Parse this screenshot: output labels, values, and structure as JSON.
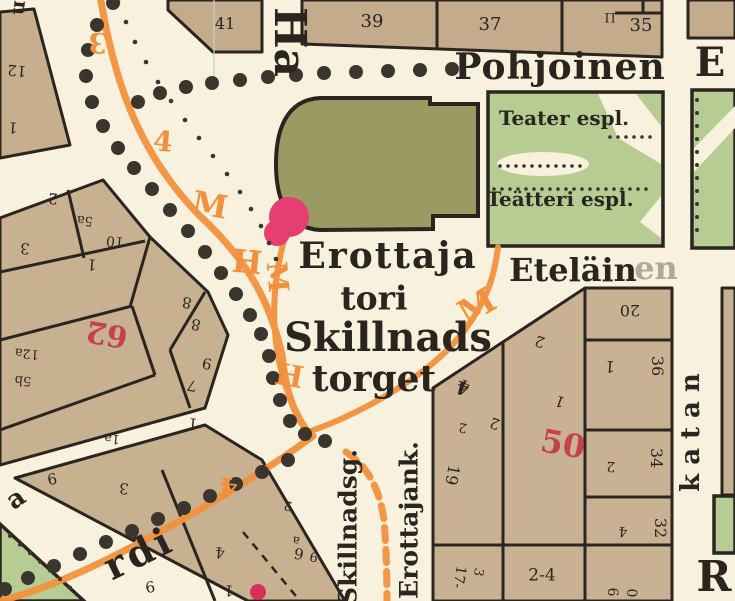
{
  "map": {
    "colors": {
      "background": "#f8f1dd",
      "block_tan": "#c8b191",
      "block_tan_top": "#c3ab8c",
      "park_green": "#b6cc92",
      "theater_olive": "#9a9b62",
      "route_orange": "#f2913d",
      "red_number": "#c4424d",
      "pink_marker": "#e63e72",
      "ink_black": "#2b2520"
    },
    "labels": [
      {
        "n": "street-pohjoinen",
        "t": "Pohjoinen",
        "x": 560,
        "y": 67,
        "s": 36,
        "w": 700,
        "ls": 1
      },
      {
        "n": "street-esplanad-e",
        "t": "E",
        "x": 710,
        "y": 63,
        "s": 40,
        "w": 700
      },
      {
        "n": "street-ha",
        "t": "Ha",
        "x": 289,
        "y": 42,
        "r": 90,
        "s": 44,
        "w": 700
      },
      {
        "n": "park-label-teater",
        "t": "Teater espl.",
        "x": 564,
        "y": 118,
        "s": 20,
        "w": 700
      },
      {
        "n": "park-label-teatteri",
        "t": "Teätteri espl.",
        "x": 560,
        "y": 199,
        "s": 20,
        "w": 700
      },
      {
        "n": "square-erottaja",
        "t": "Erottaja",
        "x": 388,
        "y": 256,
        "s": 36,
        "w": 700,
        "ls": 2
      },
      {
        "n": "square-tori",
        "t": "tori",
        "x": 374,
        "y": 298,
        "s": 33,
        "w": 700
      },
      {
        "n": "square-skillnads",
        "t": "Skillnads",
        "x": 388,
        "y": 338,
        "s": 40,
        "w": 700
      },
      {
        "n": "square-torget",
        "t": "torget",
        "x": 374,
        "y": 379,
        "s": 36,
        "w": 700
      },
      {
        "n": "street-etelainen",
        "t": "Eteläin",
        "x": 573,
        "y": 270,
        "s": 32,
        "w": 700
      },
      {
        "n": "street-etelainen-faded",
        "t": "en",
        "x": 656,
        "y": 268,
        "s": 32,
        "w": 700,
        "o": 0.35
      },
      {
        "n": "street-skillnadsg",
        "t": "Skillnadsg.",
        "x": 348,
        "y": 527,
        "r": -90,
        "s": 25,
        "w": 700
      },
      {
        "n": "street-erottajank",
        "t": "Erottajank.",
        "x": 409,
        "y": 520,
        "r": -90,
        "s": 25,
        "w": 700
      },
      {
        "n": "street-katan",
        "t": "katan",
        "x": 691,
        "y": 428,
        "r": -90,
        "s": 26,
        "w": 700,
        "ls": 9
      },
      {
        "n": "street-r",
        "t": "R",
        "x": 714,
        "y": 577,
        "s": 42,
        "w": 700
      },
      {
        "n": "street-rdi",
        "t": "rdi",
        "x": 139,
        "y": 553,
        "r": -26,
        "s": 38,
        "w": 700,
        "ls": 4
      },
      {
        "n": "street-letter-a",
        "t": "a",
        "x": 16,
        "y": 499,
        "r": -35,
        "s": 26,
        "w": 700
      },
      {
        "n": "street-letter-n",
        "t": "n",
        "x": 21,
        "y": 8,
        "r": 95,
        "s": 20,
        "w": 700
      },
      {
        "n": "plot-number",
        "t": "41",
        "x": 225,
        "y": 24,
        "s": 16
      },
      {
        "n": "plot-number",
        "t": "39",
        "x": 372,
        "y": 22,
        "s": 18
      },
      {
        "n": "plot-number",
        "t": "37",
        "x": 490,
        "y": 25,
        "s": 18
      },
      {
        "n": "plot-number",
        "t": "35",
        "x": 641,
        "y": 26,
        "s": 18
      },
      {
        "n": "landmark-symbol",
        "t": "Π",
        "x": 610,
        "y": 19,
        "s": 13
      },
      {
        "n": "plot-number",
        "t": "12",
        "x": 17,
        "y": 70,
        "r": 185,
        "s": 15
      },
      {
        "n": "plot-number",
        "t": "1",
        "x": 13,
        "y": 127,
        "r": 185,
        "s": 15
      },
      {
        "n": "plot-number",
        "t": "2",
        "x": 53,
        "y": 198,
        "r": 185,
        "s": 15
      },
      {
        "n": "plot-number",
        "t": "5a",
        "x": 85,
        "y": 220,
        "r": 185,
        "s": 13
      },
      {
        "n": "plot-number",
        "t": "3",
        "x": 25,
        "y": 248,
        "r": 185,
        "s": 15
      },
      {
        "n": "plot-number",
        "t": "10",
        "x": 115,
        "y": 241,
        "r": 185,
        "s": 14
      },
      {
        "n": "plot-number",
        "t": "1",
        "x": 92,
        "y": 264,
        "r": 185,
        "s": 15
      },
      {
        "n": "plot-number",
        "t": "8",
        "x": 187,
        "y": 302,
        "r": 190,
        "s": 15
      },
      {
        "n": "plot-number",
        "t": "8",
        "x": 196,
        "y": 324,
        "r": 190,
        "s": 15
      },
      {
        "n": "plot-number",
        "t": "9",
        "x": 207,
        "y": 363,
        "r": 190,
        "s": 15
      },
      {
        "n": "plot-number",
        "t": "7",
        "x": 192,
        "y": 385,
        "r": 190,
        "s": 15
      },
      {
        "n": "plot-number",
        "t": "12a",
        "x": 27,
        "y": 353,
        "r": 185,
        "s": 13
      },
      {
        "n": "plot-number",
        "t": "5b",
        "x": 23,
        "y": 380,
        "r": 185,
        "s": 13
      },
      {
        "n": "block-number-62",
        "t": "62",
        "x": 107,
        "y": 333,
        "r": 190,
        "s": 30,
        "w": 700,
        "c": "#c4424d"
      },
      {
        "n": "plot-number",
        "t": "1a",
        "x": 112,
        "y": 438,
        "r": 185,
        "s": 13
      },
      {
        "n": "plot-number",
        "t": "3",
        "x": 124,
        "y": 488,
        "r": 185,
        "s": 15
      },
      {
        "n": "plot-number",
        "t": "9",
        "x": 52,
        "y": 478,
        "r": 170,
        "s": 15
      },
      {
        "n": "plot-number",
        "t": "1",
        "x": 193,
        "y": 423,
        "r": 185,
        "s": 15
      },
      {
        "n": "plot-number",
        "t": "4",
        "x": 220,
        "y": 552,
        "r": 185,
        "s": 15
      },
      {
        "n": "plot-number",
        "t": "1",
        "x": 229,
        "y": 590,
        "r": 185,
        "s": 15
      },
      {
        "n": "plot-number",
        "t": "9",
        "x": 150,
        "y": 586,
        "r": 170,
        "s": 15
      },
      {
        "n": "plot-number",
        "t": "6",
        "x": 299,
        "y": 553,
        "r": 190,
        "s": 15
      },
      {
        "n": "plot-number",
        "t": "2",
        "x": 288,
        "y": 505,
        "r": 190,
        "s": 13
      },
      {
        "n": "plot-number",
        "t": "a",
        "x": 296,
        "y": 541,
        "r": 190,
        "s": 12
      },
      {
        "n": "plot-number",
        "t": "9",
        "x": 314,
        "y": 556,
        "r": 190,
        "s": 13
      },
      {
        "n": "plot-number",
        "t": "4",
        "x": 465,
        "y": 385,
        "r": 200,
        "s": 15
      },
      {
        "n": "plot-number",
        "t": "2",
        "x": 495,
        "y": 423,
        "r": 200,
        "s": 15
      },
      {
        "n": "plot-number",
        "t": "2",
        "x": 540,
        "y": 341,
        "r": 200,
        "s": 15
      },
      {
        "n": "plot-number",
        "t": "1",
        "x": 560,
        "y": 401,
        "r": 200,
        "s": 15
      },
      {
        "n": "plot-number",
        "t": "20",
        "x": 630,
        "y": 310,
        "r": 180,
        "s": 16
      },
      {
        "n": "plot-number",
        "t": "1",
        "x": 610,
        "y": 366,
        "r": 185,
        "s": 16
      },
      {
        "n": "plot-number",
        "t": "36",
        "x": 657,
        "y": 366,
        "r": 90,
        "s": 16
      },
      {
        "n": "plot-number",
        "t": "2",
        "x": 611,
        "y": 466,
        "r": 185,
        "s": 14
      },
      {
        "n": "plot-number",
        "t": "34",
        "x": 656,
        "y": 458,
        "r": 90,
        "s": 16
      },
      {
        "n": "plot-number",
        "t": "4",
        "x": 623,
        "y": 531,
        "r": 185,
        "s": 14
      },
      {
        "n": "plot-number",
        "t": "32",
        "x": 660,
        "y": 528,
        "r": 90,
        "s": 16
      },
      {
        "n": "plot-number",
        "t": "6",
        "x": 612,
        "y": 592,
        "r": 90,
        "s": 14
      },
      {
        "n": "plot-number",
        "t": "0",
        "x": 631,
        "y": 593,
        "r": 90,
        "s": 14
      },
      {
        "n": "plot-number",
        "t": "19",
        "x": 452,
        "y": 475,
        "r": 100,
        "s": 16
      },
      {
        "n": "plot-number",
        "t": "2",
        "x": 463,
        "y": 427,
        "r": 190,
        "s": 13
      },
      {
        "n": "plot-number",
        "t": "17-",
        "x": 459,
        "y": 577,
        "r": 100,
        "s": 14
      },
      {
        "n": "plot-number",
        "t": "3",
        "x": 478,
        "y": 572,
        "r": 100,
        "s": 13
      },
      {
        "n": "plot-number",
        "t": "2-4",
        "x": 542,
        "y": 576,
        "s": 17
      },
      {
        "n": "block-number-50",
        "t": "50",
        "x": 563,
        "y": 444,
        "r": 10,
        "s": 32,
        "w": 700,
        "c": "#c4424d"
      },
      {
        "n": "route-letter",
        "t": "3",
        "x": 98,
        "y": 42,
        "r": 185,
        "s": 28,
        "w": 700,
        "c": "#f2913d"
      },
      {
        "n": "route-letter",
        "t": "4",
        "x": 163,
        "y": 142,
        "r": 5,
        "s": 28,
        "w": 700,
        "c": "#f2913d"
      },
      {
        "n": "route-letter",
        "t": "M",
        "x": 210,
        "y": 205,
        "r": 10,
        "s": 32,
        "w": 700,
        "c": "#f2913d"
      },
      {
        "n": "route-letter",
        "t": "H",
        "x": 247,
        "y": 262,
        "r": 5,
        "s": 32,
        "w": 700,
        "c": "#f2913d"
      },
      {
        "n": "route-letter",
        "t": "M",
        "x": 277,
        "y": 277,
        "r": 85,
        "s": 28,
        "w": 700,
        "c": "#f2913d"
      },
      {
        "n": "route-letter",
        "t": "H",
        "x": 289,
        "y": 377,
        "r": 10,
        "s": 30,
        "w": 700,
        "c": "#f2913d"
      },
      {
        "n": "route-letter",
        "t": "M",
        "x": 477,
        "y": 307,
        "r": -30,
        "s": 34,
        "w": 700,
        "c": "#f2913d"
      },
      {
        "n": "route-letter",
        "t": "4",
        "x": 228,
        "y": 487,
        "r": 185,
        "s": 28,
        "w": 700,
        "c": "#f2913d"
      },
      {
        "n": "route-marker-black",
        "t": "4",
        "x": 463,
        "y": 387,
        "r": 195,
        "s": 18,
        "w": 700
      }
    ]
  }
}
